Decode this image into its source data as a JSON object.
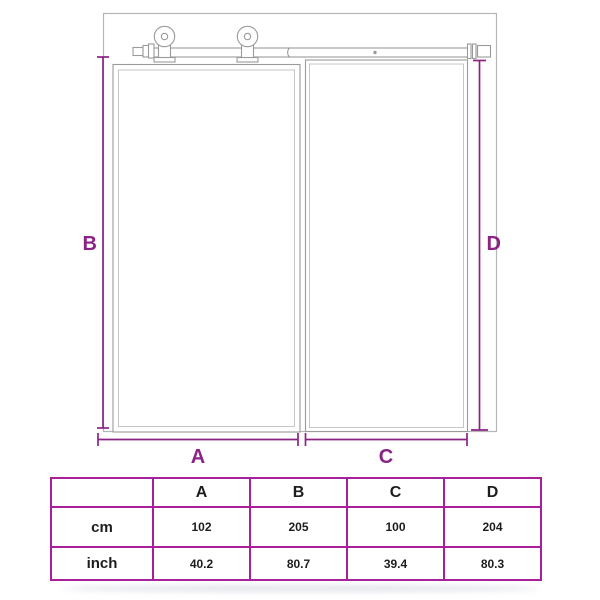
{
  "colors": {
    "dim": "#8b2385",
    "line": "#9a9a9a",
    "lineLight": "#c6c6c6",
    "wall": "#b5b5b5",
    "text": "#1d1d1d",
    "tableBorder": "#a7209a"
  },
  "diagram": {
    "labels": {
      "a": "A",
      "b": "B",
      "c": "C",
      "d": "D"
    }
  },
  "table": {
    "columns": [
      "A",
      "B",
      "C",
      "D"
    ],
    "rows": [
      {
        "label": "cm",
        "values": [
          "102",
          "205",
          "100",
          "204"
        ]
      },
      {
        "label": "inch",
        "values": [
          "40.2",
          "80.7",
          "39.4",
          "80.3"
        ]
      }
    ]
  }
}
